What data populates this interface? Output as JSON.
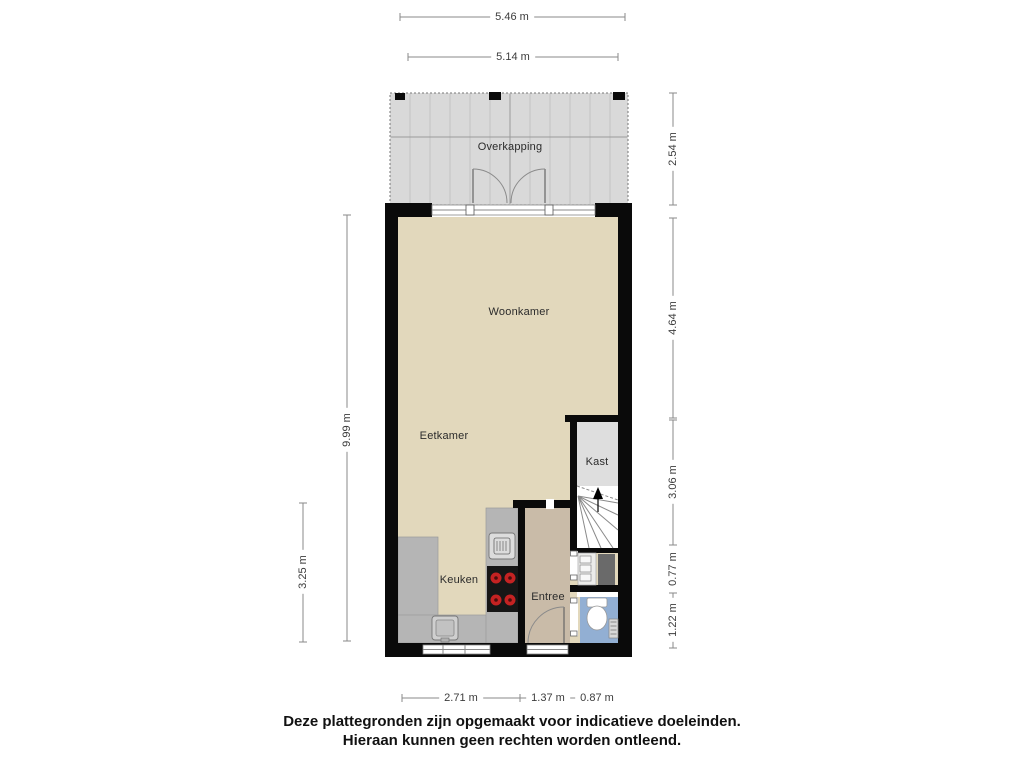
{
  "rooms": {
    "overkapping": "Overkapping",
    "woonkamer": "Woonkamer",
    "eetkamer": "Eetkamer",
    "kast": "Kast",
    "keuken": "Keuken",
    "entree": "Entree"
  },
  "dimensions": {
    "top_outer": "5.46 m",
    "top_inner": "5.14 m",
    "right_overkapping": "2.54 m",
    "right_woonkamer": "4.64 m",
    "right_stairs": "3.06 m",
    "right_meterkast": "0.77 m",
    "right_toilet": "1.22 m",
    "left_interior": "9.99 m",
    "left_kitchen": "3.25 m",
    "bottom_kitchen": "2.71 m",
    "bottom_entree": "1.37 m",
    "bottom_toilet": "0.87 m"
  },
  "footer": {
    "line1": "Deze plattegronden zijn opgemaakt voor indicatieve doeleinden.",
    "line2": "Hieraan kunnen geen rechten worden ontleend."
  },
  "colors": {
    "floor-main": "#e2d8bc",
    "floor-entree": "#c9bba8",
    "floor-kast": "#dedede",
    "floor-overkapping": "#d9d9d9",
    "floor-toilet": "#92afd3",
    "counter": "#b5b5b5",
    "wall": "#0a0a0a",
    "burner": "#c42222",
    "dim-line": "#8a8a8a"
  }
}
